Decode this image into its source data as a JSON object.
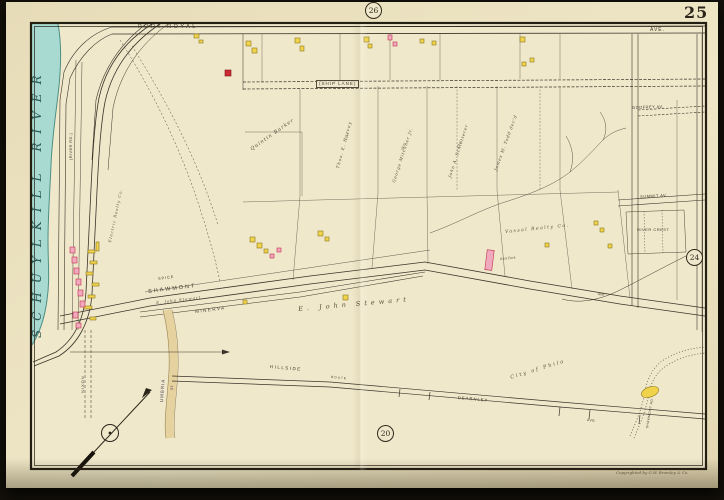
{
  "plate": {
    "number": "25",
    "adjoining_plate_top": "26",
    "adjoining_plate_right": "24",
    "adjoining_plate_bottom": "20",
    "copyright": "Copyrighted by G.W. Bromley & Co."
  },
  "river": {
    "name": "SCHUYLKILL RIVER"
  },
  "streets": {
    "port_royal": "PORT ROYAL",
    "port_royal_ave": "AVE.",
    "ship_lane": "(SHIP LANE)",
    "godfrey": "GODFREY AV.",
    "summit": "SUMMIT AV.",
    "river_crest": "RIVER CREST",
    "shawmont": "SHAWMONT",
    "minerva": "MINERVA",
    "spice": "SPICE",
    "umbria": "UMBRIA",
    "umbria_st": "ST",
    "nixon": "NIXON",
    "river_rd": "(RIVER RD.)",
    "hillside": "HILLSIDE",
    "route": "ROUTE",
    "dearnley": "DEARNLEY",
    "dearnley_ave": "AVE",
    "shawmont_ave_small": "AVE",
    "shawmont_rd": "SHAWMONT RD"
  },
  "owners": {
    "barker": "Quintin Barker",
    "harvey": "Thos. E. Harvey",
    "harvey_acres": "13 ac",
    "mitchner": "George Mitchner Jr.",
    "mitchner_acres": "20 ac",
    "schlotterer": "John A. Schlotterer",
    "schlotterer_acres": "23 ac",
    "todd": "James M. Todd dec'd",
    "stewart": "E. John Stewart",
    "stewart_small": "E. John Stewart",
    "realty": "Vassal Realty Co.",
    "city": "City of Phila",
    "electric": "Electric Realty Co.",
    "east_park": "East Park"
  },
  "icons": {
    "compass": "compass-rose"
  },
  "colors": {
    "river": "#a9dad2",
    "building_yellow": "#f1d24b",
    "building_pink": "#f0a9bd",
    "page": "#e9dfbe",
    "ink": "#3a332a"
  }
}
